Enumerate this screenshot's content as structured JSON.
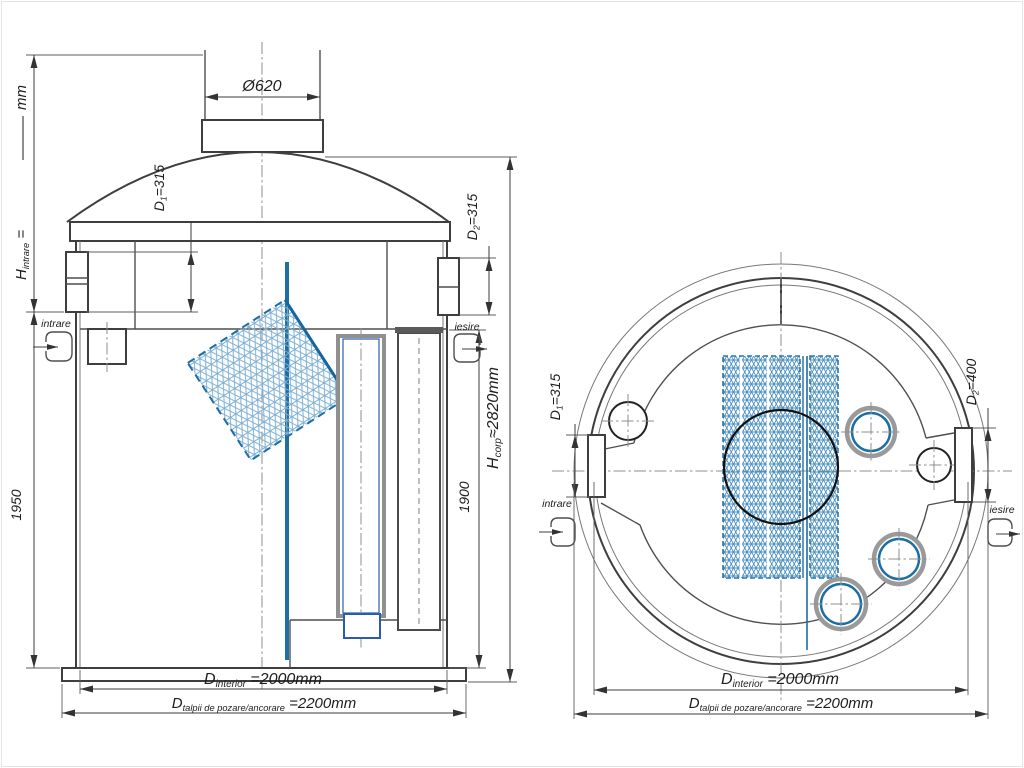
{
  "drawing_type": "separator-tank-technical-drawing",
  "colors": {
    "line": "#3e3e3e",
    "accent_blue": "#1c6ea4",
    "mesh_blue_front": "#7fb0d4",
    "mesh_blue_top": "#4a8fbf"
  },
  "front": {
    "h_intrare": {
      "p": "H",
      "s": "intrare",
      "eq": " =",
      "unit": "mm"
    },
    "d1": {
      "p": "D",
      "s": "1",
      "v": "=315"
    },
    "phi": "Ø620",
    "d2": {
      "p": "D",
      "s": "2",
      "v": "=315"
    },
    "intrare": "intrare",
    "iesire": "iesire",
    "h_left": "1950",
    "h_right": "1900",
    "h_corp": {
      "p": "H",
      "s": "corp",
      "v": "≈2820mm"
    },
    "d_int": {
      "p": "D",
      "s": "interior",
      "v": " =2000mm"
    },
    "d_talpa": {
      "p": "D",
      "s": "talpii de pozare/ancorare",
      "v": " =2200mm"
    }
  },
  "top": {
    "d1": {
      "p": "D",
      "s": "1",
      "v": "=315"
    },
    "d2": {
      "p": "D",
      "s": "2",
      "v": "=400"
    },
    "intrare": "intrare",
    "iesire": "iesire",
    "d_int": {
      "p": "D",
      "s": "interior",
      "v": " =2000mm"
    },
    "d_talpa": {
      "p": "D",
      "s": "talpii de pozare/ancorare",
      "v": " =2200mm"
    }
  }
}
